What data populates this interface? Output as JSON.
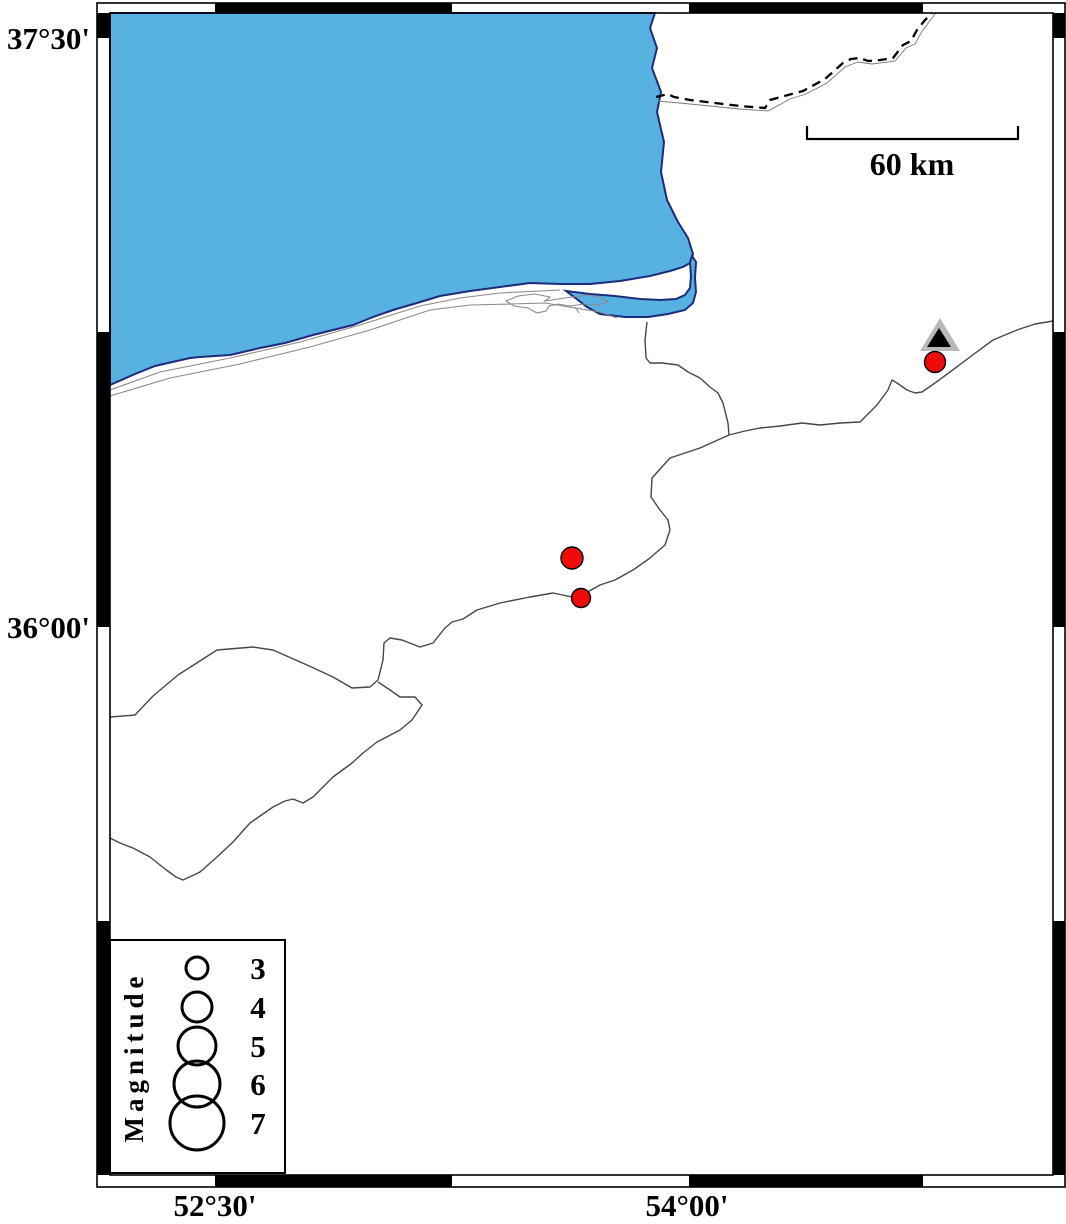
{
  "axes": {
    "left": [
      {
        "label": "37°30'"
      },
      {
        "label": "36°00'"
      }
    ],
    "bottom": [
      {
        "label": "52°30'"
      },
      {
        "label": "54°00'"
      }
    ]
  },
  "scale_bar": {
    "label": "60 km"
  },
  "legend": {
    "title": "Magnitude",
    "entries": [
      {
        "magnitude": "3"
      },
      {
        "magnitude": "4"
      },
      {
        "magnitude": "5"
      },
      {
        "magnitude": "6"
      },
      {
        "magnitude": "7"
      }
    ]
  },
  "map": {
    "colors": {
      "sea": "#57B1E1",
      "coastline": "#1d2b7d",
      "earthquake_fill": "#f00a0a",
      "station_outer": "#b9b9b9",
      "station_inner": "#000000",
      "frame": "#000000"
    }
  }
}
